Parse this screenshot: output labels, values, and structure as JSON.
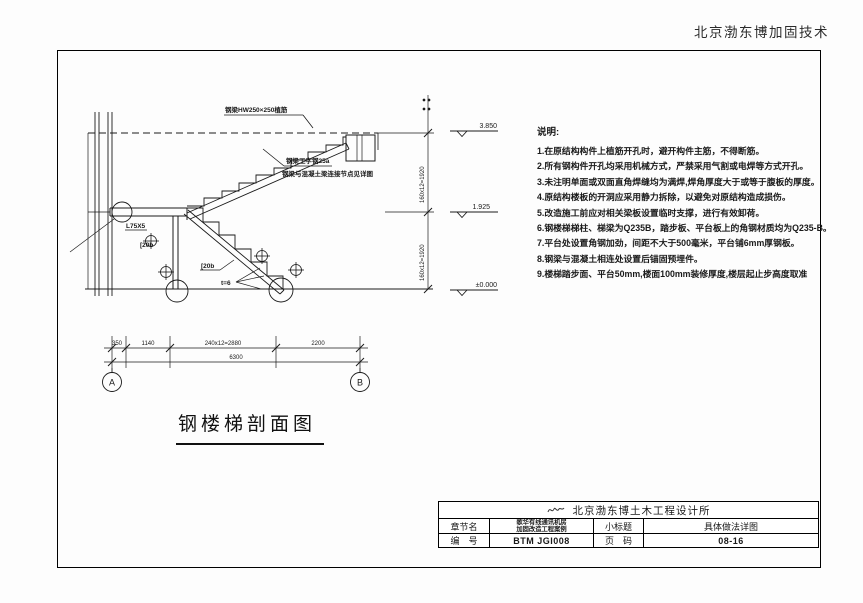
{
  "header": {
    "company": "北京渤东博加固技术"
  },
  "drawing": {
    "title": "钢楼梯剖面图",
    "elevations": [
      "3.850",
      "1.925",
      "±0.000"
    ],
    "dims_vertical": [
      "160x12=1920",
      "160x12=1920"
    ],
    "dims_bottom": [
      "350",
      "1140",
      "240x12=2880",
      "2200"
    ],
    "dim_total": "6300",
    "grid": [
      "A",
      "B"
    ],
    "callouts": {
      "top_beam": "钢梁HW250×250植筋",
      "mid_line1": "钢梁工字钢25a",
      "mid_line2": "钢梁与混凝土梁连接节点见详图",
      "angle_steel": "L75X5",
      "channel_upper": "[20b",
      "channel_lower": "[20b",
      "plate_thickness": "t=6"
    }
  },
  "notes": {
    "title": "说明:",
    "items": [
      "1.在原结构构件上植筋开孔时，避开构件主筋，不得断筋。",
      "2.所有钢构件开孔均采用机械方式，严禁采用气割或电焊等方式开孔。",
      "3.未注明单面或双面直角焊缝均为满焊,焊角厚度大于或等于腹板的厚度。",
      "4.原结构楼板的开洞应采用静力拆除，以避免对原结构造成损伤。",
      "5.改造施工前应对相关梁板设置临时支撑，进行有效卸荷。",
      "6.钢楼梯梯柱、梯梁为Q235B，踏步板、平台板上的角钢材质均为Q235-B。",
      "7.平台处设置角钢加劲，间距不大于500毫米，平台铺6mm厚钢板。",
      "8.钢梁与混凝土相连处设置后锚固预埋件。",
      "9.楼梯踏步面、平台50mm,楼面100mm装修厚度,楼层起止步高度取准"
    ]
  },
  "titleblock": {
    "institute": "北京渤东博土木工程设计所",
    "logo_icon": "signature-squiggle",
    "section_label": "章节名",
    "project_line1": "歌华有线通讯机房",
    "project_line2": "加固改造工程案例",
    "subtitle_label": "小标题",
    "subtitle_value": "具体做法详图",
    "number_label": "编　号",
    "number_value": "BTM JGI008",
    "page_label": "页　码",
    "page_value": "08-16"
  }
}
